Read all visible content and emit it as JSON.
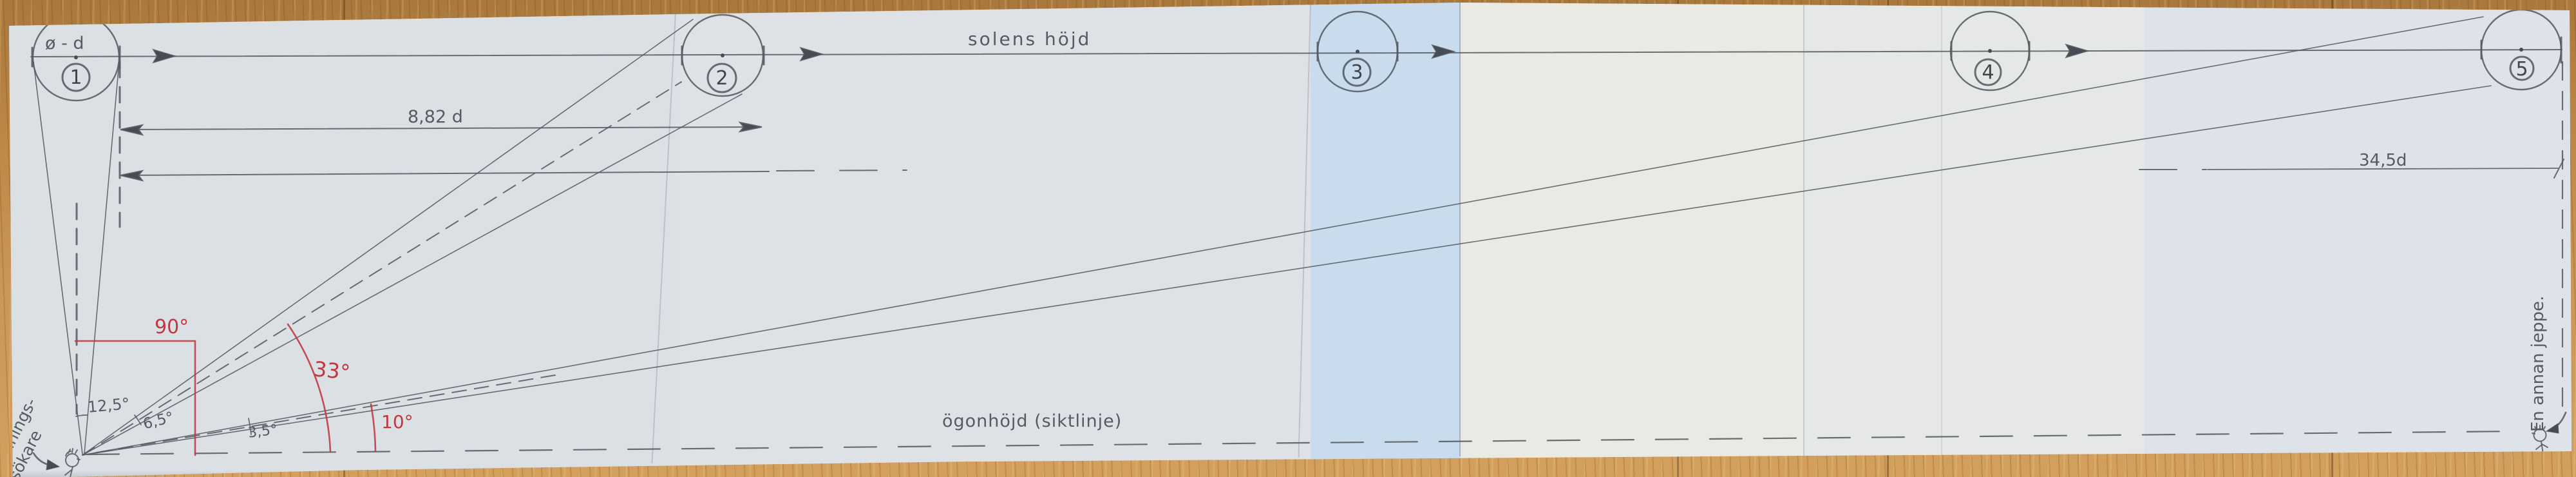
{
  "labels": {
    "circle1_diameter": "ø - d",
    "distance_1_2": "8,82 d",
    "distance_1_5": "34,5d",
    "sun_height_line": "solens höjd",
    "eye_height_line": "ögonhöjd (siktlinje)",
    "left_figure_line1": "Sannings-",
    "left_figure_line2": "sökare",
    "right_figure": "En annan jeppe."
  },
  "angles": {
    "right_angle": "90°",
    "mirror2_elevation": "33°",
    "mirror5_elevation": "10°",
    "cone1_width": "12,5°",
    "cone2_width": "6,5°",
    "cone5_width": "3,5°"
  },
  "circles": [
    {
      "number": "1"
    },
    {
      "number": "2"
    },
    {
      "number": "3"
    },
    {
      "number": "4"
    },
    {
      "number": "5"
    }
  ],
  "colors": {
    "ink": "#555b61",
    "red": "#c13741",
    "paper": "#dce1e6",
    "paper_blue": "#c8dcee",
    "paper_warm": "#ebe9e3",
    "wood": "#c4924e"
  }
}
